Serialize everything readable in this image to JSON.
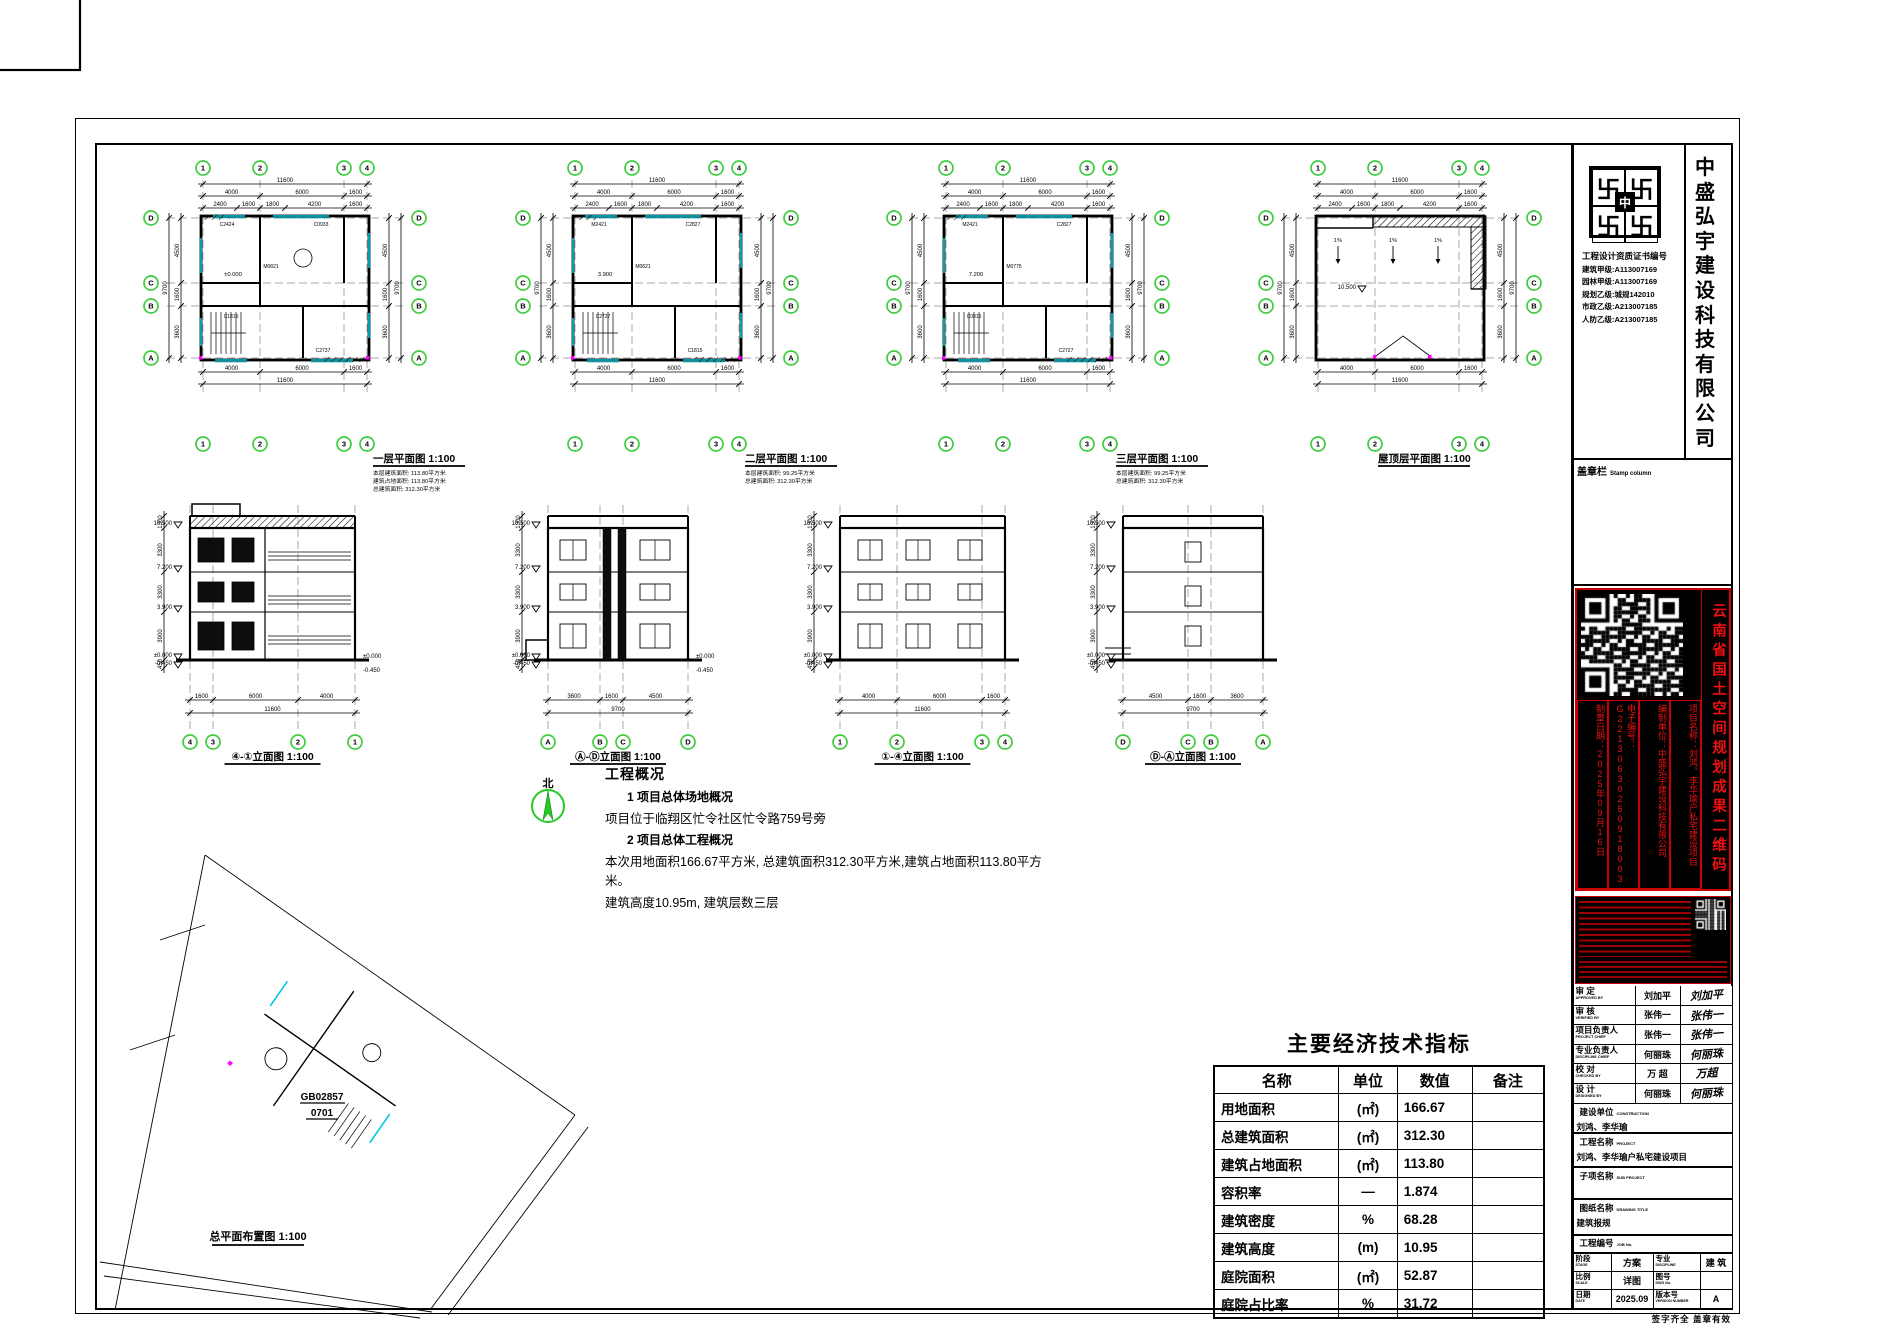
{
  "colors": {
    "axis_green": "#3fcc3f",
    "stamp_red": "#dd1111",
    "cyan": "#00c8dc",
    "magenta": "#ff00ff"
  },
  "plans": [
    {
      "label": "一层平面图",
      "scale": "1:100",
      "level": "±0.000",
      "codes": [
        "C2424",
        "C0933",
        "M0821",
        "C1815",
        "C2737"
      ],
      "notes": [
        "本层建筑面积: 113.80平方米",
        "建筑占地面积: 113.80平方米",
        "总建筑面积: 312.30平方米"
      ]
    },
    {
      "label": "二层平面图",
      "scale": "1:100",
      "level": "3.900",
      "codes": [
        "M2421",
        "C2827",
        "M0821",
        "C2727",
        "C1815"
      ],
      "notes": [
        "本层建筑面积: 99.25平方米",
        "总建筑面积: 312.30平方米"
      ]
    },
    {
      "label": "三层平面图",
      "scale": "1:100",
      "level": "7.200",
      "codes": [
        "M2421",
        "C2827",
        "M0775",
        "C0815",
        "C2727"
      ],
      "notes": [
        "本层建筑面积: 99.25平方米",
        "总建筑面积: 312.30平方米"
      ]
    },
    {
      "label": "屋顶层平面图",
      "scale": "1:100",
      "level": "10.500",
      "codes": [],
      "notes": []
    }
  ],
  "plan_axes": {
    "horizontal": [
      "1",
      "2",
      "3",
      "4"
    ],
    "vertical": [
      "D",
      "C",
      "B",
      "A"
    ]
  },
  "plan_dims": {
    "top_total": "11600",
    "top_segs": [
      "4000",
      "6000",
      "1600"
    ],
    "top_subs": [
      "2400",
      "1600",
      "1800",
      "4200",
      "1600"
    ],
    "side_total": "9700",
    "side_segs": [
      "4500",
      "1600",
      "3600"
    ]
  },
  "slope_label": "1%",
  "elevations": [
    {
      "label": "④-①立面图",
      "scale": "1:100",
      "axes": [
        "4",
        "3",
        "2",
        "1"
      ],
      "segs": [
        "1600",
        "6000",
        "4000"
      ],
      "total": "11600"
    },
    {
      "label": "Ⓐ-Ⓓ立面图",
      "scale": "1:100",
      "axes": [
        "A",
        "B",
        "C",
        "D"
      ],
      "segs": [
        "3600",
        "1600",
        "4500"
      ],
      "total": "9700"
    },
    {
      "label": "①-④立面图",
      "scale": "1:100",
      "axes": [
        "1",
        "2",
        "3",
        "4"
      ],
      "segs": [
        "4000",
        "6000",
        "1600"
      ],
      "total": "11600"
    },
    {
      "label": "Ⓓ-Ⓐ立面图",
      "scale": "1:100",
      "axes": [
        "D",
        "C",
        "B",
        "A"
      ],
      "segs": [
        "4500",
        "1600",
        "3600"
      ],
      "total": "9700"
    }
  ],
  "elevation_levels": [
    "10.500",
    "7.200",
    "3.900",
    "±0.000",
    "-0.450"
  ],
  "elevation_heights": [
    "1300",
    "3300",
    "3300",
    "3900",
    "450"
  ],
  "site": {
    "north": "北",
    "plot_code": "GB02857",
    "plot_code2": "0701",
    "label": "总平面布置图",
    "scale": "1:100"
  },
  "overview": {
    "title": "工程概况",
    "h1": "1  项目总体场地概况",
    "l1": "项目位于临翔区忙令社区忙令路759号旁",
    "h2": "2  项目总体工程概况",
    "l2": "本次用地面积166.67平方米, 总建筑面积312.30平方米,建筑占地面积113.80平方米。",
    "l3": "建筑高度10.95m, 建筑层数三层"
  },
  "indicators": {
    "title": "主要经济技术指标",
    "headers": [
      "名称",
      "单位",
      "数值",
      "备注"
    ],
    "rows": [
      [
        "用地面积",
        "(㎡)",
        "166.67",
        ""
      ],
      [
        "总建筑面积",
        "(㎡)",
        "312.30",
        ""
      ],
      [
        "建筑占地面积",
        "(㎡)",
        "113.80",
        ""
      ],
      [
        "容积率",
        "—",
        "1.874",
        ""
      ],
      [
        "建筑密度",
        "%",
        "68.28",
        ""
      ],
      [
        "建筑高度",
        "(m)",
        "10.95",
        ""
      ],
      [
        "庭院面积",
        "(㎡)",
        "52.87",
        ""
      ],
      [
        "庭院占比率",
        "%",
        "31.72",
        ""
      ]
    ]
  },
  "titleblock": {
    "company_vertical": "中盛弘宇建设科技有限公司",
    "logo_glyph": "卐",
    "logo_center": "中",
    "cert_header": "工程设计资质证书编号",
    "certs": [
      "建筑甲级:A113007169",
      "园林甲级:A113007169",
      "规划乙级:城规142010",
      "市政乙级:A213007185",
      "人防乙级:A213007185"
    ],
    "stamp_column_label": "盖章栏",
    "stamp_column_en": "Stamp column",
    "stamp1": {
      "side_text": "云南省国土空间规划成果二维码",
      "columns": [
        "项目名称：刘鸿、李华瑜户私宅建设项目",
        "编制单位：中盛弘宇建设科技有限公司",
        "电子编号：G22130630250918003",
        "制章日期：2025年09月16日"
      ]
    },
    "signatures": [
      {
        "label": "审 定",
        "en": "APPROVED BY",
        "name": "刘加平",
        "sig": "刘加平"
      },
      {
        "label": "审 核",
        "en": "VERIFIED BY",
        "name": "张伟一",
        "sig": "张伟一"
      },
      {
        "label": "项目负责人",
        "en": "PROJECT CHIEF",
        "name": "张伟一",
        "sig": "张伟一"
      },
      {
        "label": "专业负责人",
        "en": "DISCIPLINE CHIEF",
        "name": "何丽珠",
        "sig": "何丽珠"
      },
      {
        "label": "校 对",
        "en": "CHECKED BY",
        "name": "万 超",
        "sig": "万超"
      },
      {
        "label": "设 计",
        "en": "DESIGNED BY",
        "name": "何丽珠",
        "sig": "何丽珠"
      }
    ],
    "construction_label": "建设单位",
    "construction_en": "CONSTRUCTION",
    "construction_value": "刘鸿、李华瑜",
    "project_label": "工程名称",
    "project_en": "PROJECT",
    "project_value": "刘鸿、李华瑜户私宅建设项目",
    "subproject_label": "子项名称",
    "subproject_en": "SUB PROJECT",
    "subproject_value": "",
    "drawing_title_label": "图纸名称",
    "drawing_title_en": "DRAWING TITLE",
    "drawing_title_value": "建筑报规",
    "job_label": "工程编号",
    "job_en": "JOB No.",
    "job_value": "",
    "grid": {
      "stage_label": "阶段",
      "stage_en": "STAGE",
      "stage_value": "方案",
      "discipline_label": "专业",
      "discipline_en": "DISCIPLINE",
      "discipline_value": "建 筑",
      "scale_label": "比例",
      "scale_en": "SCALE",
      "scale_value": "详图",
      "dwg_label": "图号",
      "dwg_en": "DWG No.",
      "dwg_value": "",
      "date_label": "日期",
      "date_en": "DATE",
      "date_value": "2025.09",
      "version_label": "版本号",
      "version_en": "VERSION NUMBER",
      "version_value": "A"
    },
    "bottom_note": "签字齐全 盖章有效"
  }
}
